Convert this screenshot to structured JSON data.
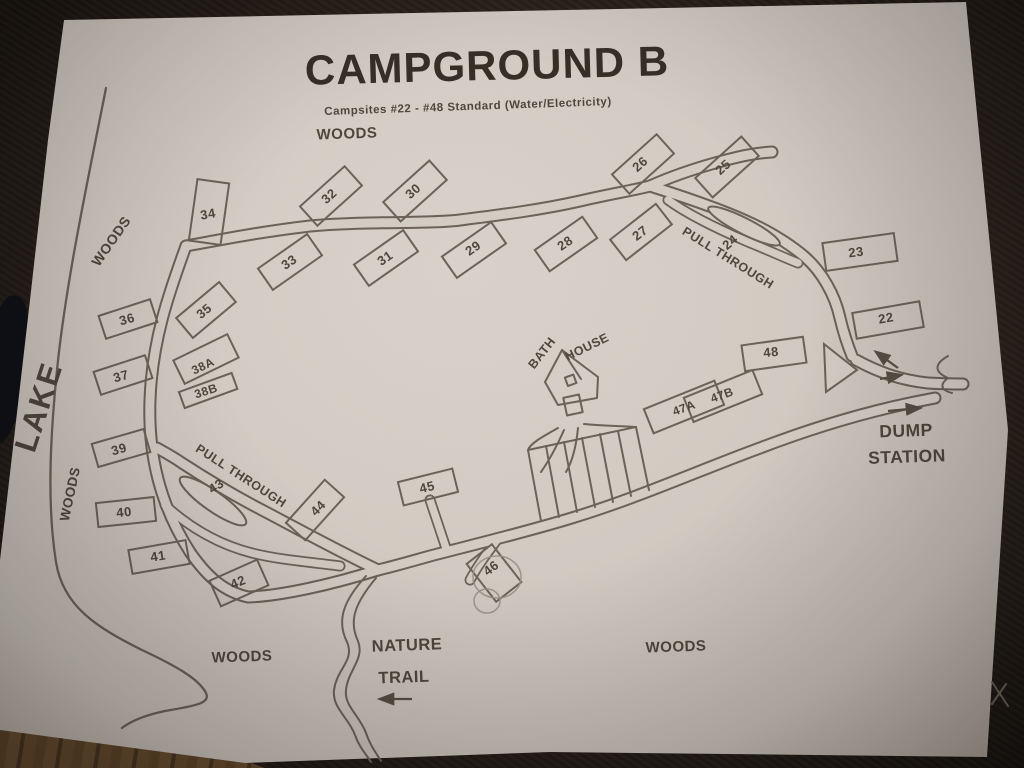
{
  "photo": {
    "scene": "paper campground map photographed on dark carpet",
    "title": "CAMPGROUND B",
    "subtitle": "Campsites #22 -  #48 Standard (Water/Electricity)",
    "labels": {
      "woods_top": "WOODS",
      "woods_left_upper": "WOODS",
      "lake": "LAKE",
      "woods_left_lower": "WOODS",
      "woods_bottom_left": "WOODS",
      "woods_bottom_right": "WOODS",
      "pull_through_upper": "PULL THROUGH",
      "pull_through_lower": "PULL THROUGH",
      "bath_house_word1": "BATH",
      "bath_house_word2": "HOUSE",
      "nature_trail_line1": "NATURE",
      "nature_trail_line2": "TRAIL",
      "dump_station_line1": "DUMP",
      "dump_station_line2": "STATION"
    },
    "sites": [
      {
        "id": "22",
        "label": "22"
      },
      {
        "id": "23",
        "label": "23"
      },
      {
        "id": "24",
        "label": "24"
      },
      {
        "id": "25",
        "label": "25"
      },
      {
        "id": "26",
        "label": "26"
      },
      {
        "id": "27",
        "label": "27"
      },
      {
        "id": "28",
        "label": "28"
      },
      {
        "id": "29",
        "label": "29"
      },
      {
        "id": "30",
        "label": "30"
      },
      {
        "id": "31",
        "label": "31"
      },
      {
        "id": "32",
        "label": "32"
      },
      {
        "id": "33",
        "label": "33"
      },
      {
        "id": "34",
        "label": "34"
      },
      {
        "id": "35",
        "label": "35"
      },
      {
        "id": "36",
        "label": "36"
      },
      {
        "id": "37",
        "label": "37"
      },
      {
        "id": "38A",
        "label": "38A"
      },
      {
        "id": "38B",
        "label": "38B"
      },
      {
        "id": "39",
        "label": "39"
      },
      {
        "id": "40",
        "label": "40"
      },
      {
        "id": "41",
        "label": "41"
      },
      {
        "id": "42",
        "label": "42"
      },
      {
        "id": "43",
        "label": "43"
      },
      {
        "id": "44",
        "label": "44"
      },
      {
        "id": "45",
        "label": "45"
      },
      {
        "id": "46",
        "label": "46"
      },
      {
        "id": "47A",
        "label": "47A"
      },
      {
        "id": "47B",
        "label": "47B"
      },
      {
        "id": "48",
        "label": "48"
      }
    ],
    "colors": {
      "paper": "#d6d0c9",
      "ink": "#6b6359",
      "text": "#4e463c",
      "carpet": "#2a231d",
      "wood_floor": "#7b5a36"
    }
  }
}
